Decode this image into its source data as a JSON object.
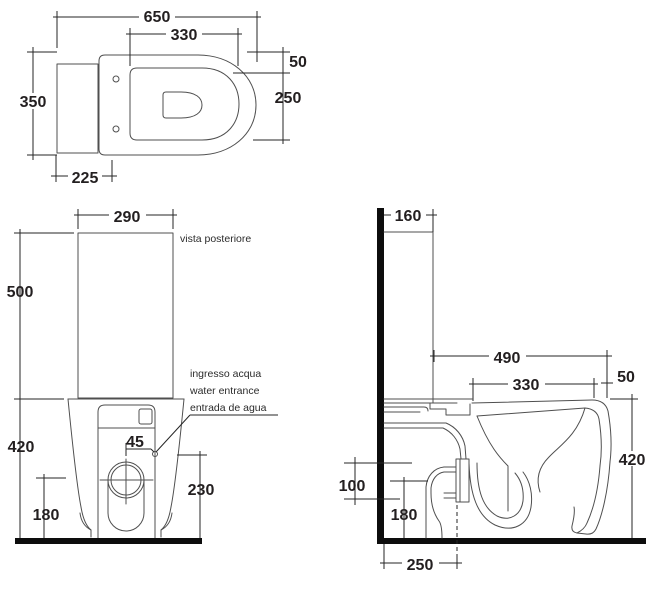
{
  "diagram": {
    "type": "sanitaryware technical drawing - back-to-wall WC, three orthographic views",
    "colors": {
      "background": "#ffffff",
      "outline": "#4f4f4f",
      "dimension": "#262626",
      "text": "#231f20",
      "wall_floor": "#0d0d0d"
    }
  },
  "top_view": {
    "dims": {
      "total_length": "650",
      "opening_length": "330",
      "rim_front_gap": "50",
      "opening_width": "250",
      "total_width": "350",
      "tank_depth": "225"
    }
  },
  "rear_view": {
    "caption": "vista posteriore",
    "water_inlet_note": [
      "ingresso acqua",
      "water entrance",
      "entrada de agua"
    ],
    "dims": {
      "tank_width": "290",
      "tank_height": "500",
      "bowl_height": "420",
      "drain_center_height": "180",
      "inlet_height": "230",
      "inlet_offset": "45"
    }
  },
  "side_view": {
    "dims": {
      "tank_depth": "160",
      "front_projection": "490",
      "rim_length": "330",
      "rim_step": "50",
      "bowl_height": "420",
      "outlet_pipe_diameter": "100",
      "outlet_center_height": "180",
      "outlet_wall_distance": "250"
    }
  }
}
